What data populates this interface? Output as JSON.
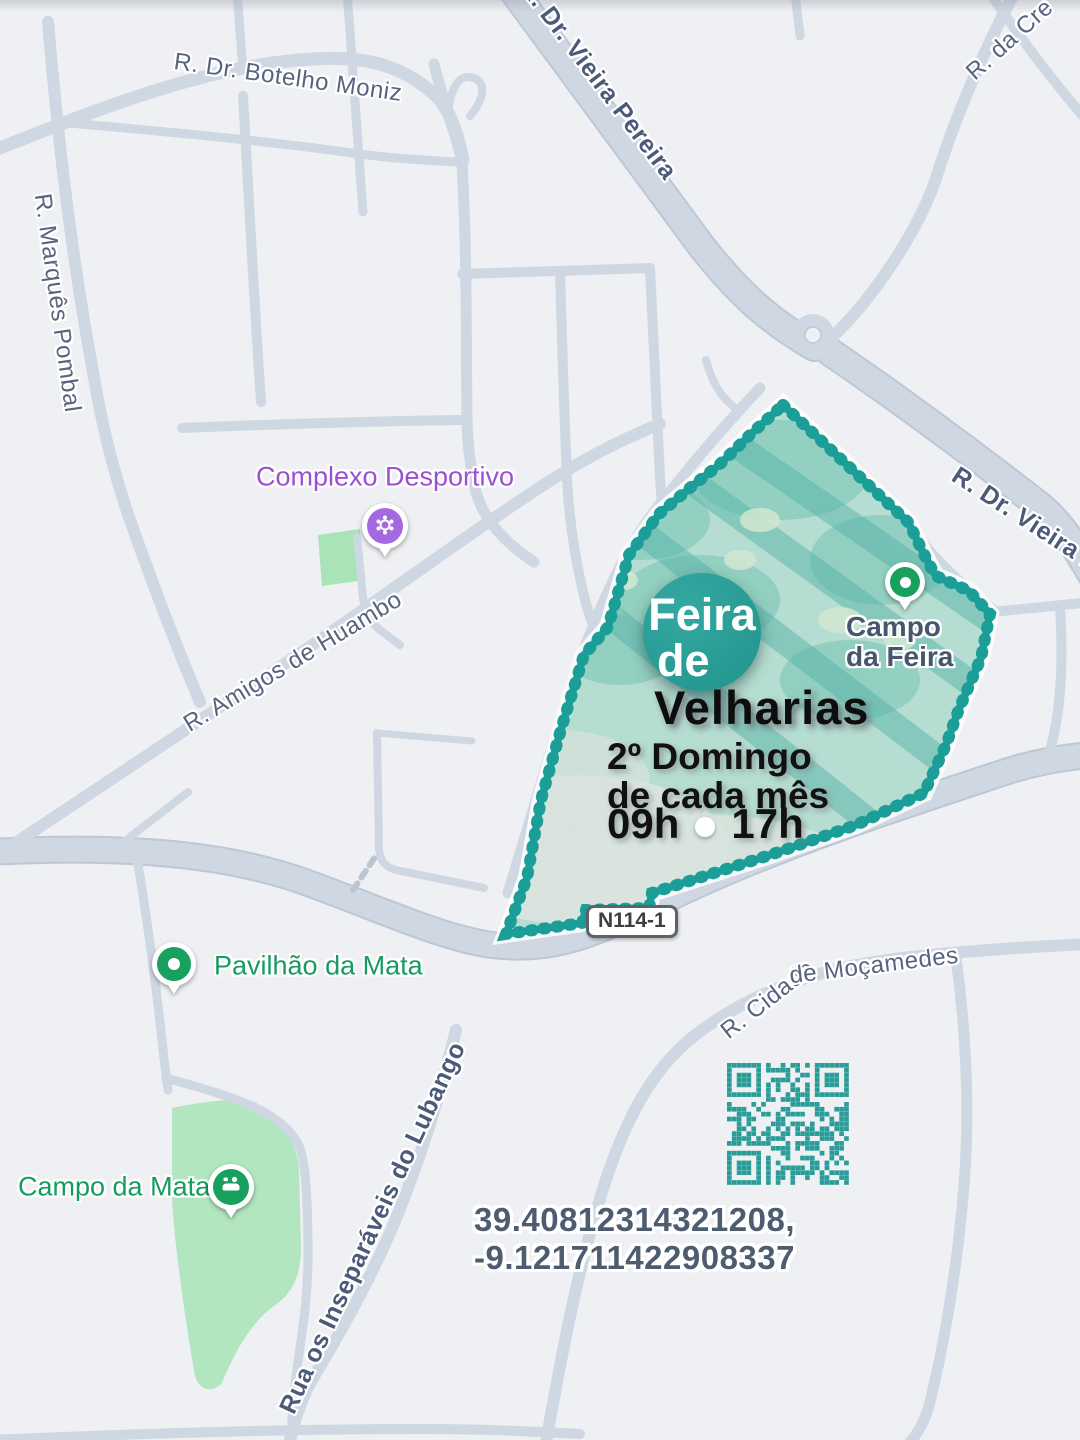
{
  "map": {
    "background_color": "#eef0f3",
    "road_color": "#cfd7e2",
    "street_labels": [
      {
        "text": "R. Dr. Botelho Moniz"
      },
      {
        "text": "R. Marquês Pombal"
      },
      {
        "text": "R. Dr. Vieira Pereira"
      },
      {
        "text": "R. da Cre"
      },
      {
        "text": "R. Dr. Vieira Pe"
      },
      {
        "text": "R. Amigos de Huambo"
      },
      {
        "text": "R. Cidade"
      },
      {
        "text": "de Moçamedes"
      },
      {
        "text": "Rua os Inseparáveis do Lubango"
      }
    ],
    "road_badge": "N114-1",
    "pois": [
      {
        "name": "Complexo Desportivo",
        "color": "#9b4fd2",
        "icon": "sports-complex"
      },
      {
        "name": "Campo da Feira",
        "name_line1": "Campo",
        "name_line2": "da Feira",
        "color": "#47566e",
        "icon": "place-dot"
      },
      {
        "name": "Pavilhão da Mata",
        "color": "#169c60",
        "icon": "place-dot"
      },
      {
        "name": "Campo da Mata",
        "color": "#169c60",
        "icon": "playground"
      }
    ]
  },
  "overlay": {
    "badge_line1": "Feira",
    "badge_line2": "de",
    "title": "Velharias",
    "schedule_line1": "2º Domingo",
    "schedule_line2": "de cada mês",
    "time_open": "09h",
    "time_close": "17h",
    "area_color": "#1b9e98"
  },
  "footer": {
    "coordinates": "39.40812314321208, -9.121711422908337",
    "qr_color": "#2a9d98"
  }
}
